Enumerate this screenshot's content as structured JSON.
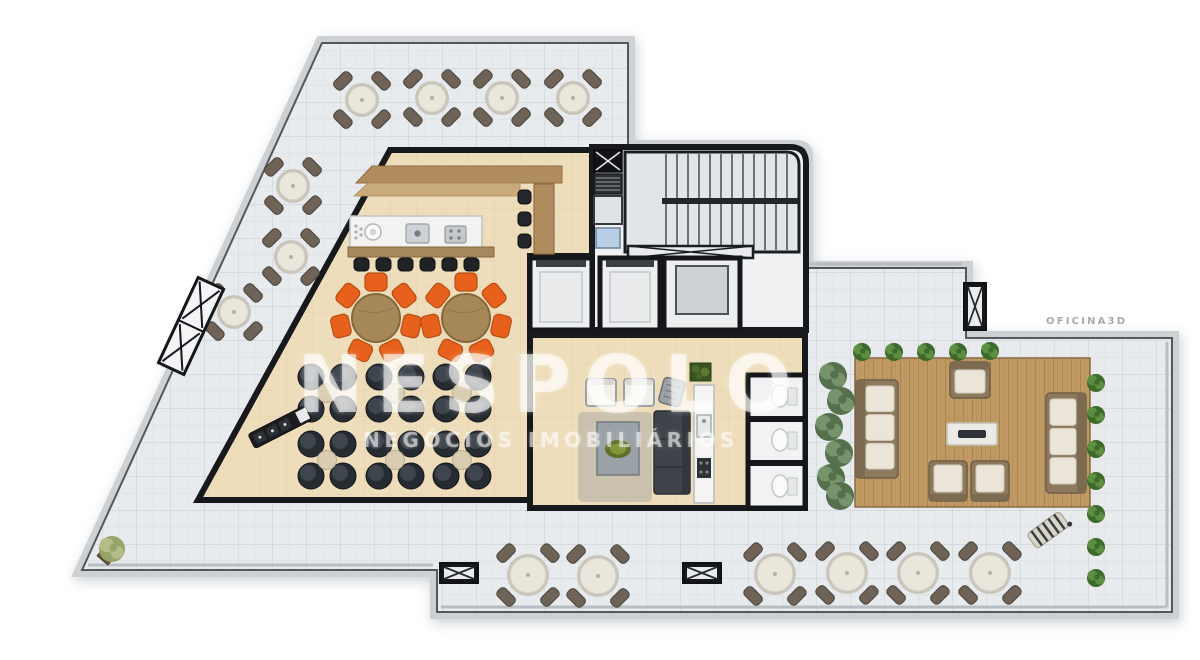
{
  "watermark": {
    "title": "NESPOLO",
    "subtitle": "NEGÓCIOS IMOBILIÁRIOS"
  },
  "credit": {
    "label": "OFICINA3D"
  },
  "palette": {
    "tile_floor": "#e8ebee",
    "tile_line": "#d0d5da",
    "room_floor": "#eeddbb",
    "wall": "#17191c",
    "wood_counter": "#b08c5e",
    "deck_wood": "#bf9a64",
    "accent_orange": "#e8611c",
    "orange_edge": "#b84e12",
    "dark_chair": "#262b31",
    "outdoor_chair": "#6e6356",
    "table_top": "#e9e6dc",
    "cushion": "#eae5d8",
    "sofa_frame": "#8d7a5e",
    "plant_green": "#3e6b2c",
    "plant_light": "#5d8f43",
    "planter_green": "#55704c",
    "planter_light": "#76936b"
  },
  "furniture": {
    "outdoor_tables": [
      {
        "x": 362,
        "y": 100,
        "r": 17
      },
      {
        "x": 432,
        "y": 98,
        "r": 17
      },
      {
        "x": 502,
        "y": 98,
        "r": 17
      },
      {
        "x": 573,
        "y": 98,
        "r": 17
      },
      {
        "x": 293,
        "y": 186,
        "r": 17
      },
      {
        "x": 291,
        "y": 257,
        "r": 17
      },
      {
        "x": 234,
        "y": 312,
        "r": 17
      },
      {
        "x": 528,
        "y": 575,
        "r": 21
      },
      {
        "x": 598,
        "y": 576,
        "r": 21
      },
      {
        "x": 775,
        "y": 574,
        "r": 21
      },
      {
        "x": 847,
        "y": 573,
        "r": 21
      },
      {
        "x": 918,
        "y": 573,
        "r": 21
      },
      {
        "x": 990,
        "y": 573,
        "r": 21
      }
    ],
    "orange_dining": [
      {
        "x": 376,
        "y": 318
      },
      {
        "x": 466,
        "y": 318
      }
    ],
    "lounge_clusters": [
      {
        "x": 327,
        "y": 393
      },
      {
        "x": 395,
        "y": 393
      },
      {
        "x": 462,
        "y": 393
      },
      {
        "x": 327,
        "y": 460
      },
      {
        "x": 395,
        "y": 460
      },
      {
        "x": 462,
        "y": 460
      }
    ],
    "bar_stools": [
      {
        "x": 354,
        "y": 258
      },
      {
        "x": 376,
        "y": 258
      },
      {
        "x": 398,
        "y": 258
      },
      {
        "x": 420,
        "y": 258
      },
      {
        "x": 442,
        "y": 258
      },
      {
        "x": 464,
        "y": 258
      }
    ],
    "counter_stools": [
      {
        "x": 518,
        "y": 190
      },
      {
        "x": 518,
        "y": 212
      },
      {
        "x": 518,
        "y": 234
      }
    ],
    "lounge_armchairs": [
      {
        "x": 586,
        "y": 379
      },
      {
        "x": 624,
        "y": 379
      }
    ],
    "grill": {
      "x": 672,
      "y": 392,
      "rot": 15
    },
    "buffet": {
      "x": 280,
      "y": 427,
      "rot": -27
    },
    "deck_sofas": [
      {
        "x": 856,
        "y": 380,
        "w": 42,
        "h": 98,
        "back": "left"
      },
      {
        "x": 1046,
        "y": 393,
        "w": 40,
        "h": 100,
        "back": "right"
      }
    ],
    "deck_armchairs": [
      {
        "x": 950,
        "y": 362,
        "w": 40,
        "h": 36,
        "back": "top"
      },
      {
        "x": 929,
        "y": 461,
        "w": 38,
        "h": 40,
        "back": "bottom"
      },
      {
        "x": 971,
        "y": 461,
        "w": 38,
        "h": 40,
        "back": "bottom"
      }
    ],
    "fire_table": {
      "x": 947,
      "y": 423,
      "w": 50,
      "h": 22
    },
    "deck_edge_plants": [
      {
        "x": 862,
        "y": 352
      },
      {
        "x": 894,
        "y": 352
      },
      {
        "x": 926,
        "y": 352
      },
      {
        "x": 958,
        "y": 352
      },
      {
        "x": 990,
        "y": 351
      },
      {
        "x": 1096,
        "y": 383
      },
      {
        "x": 1096,
        "y": 415
      },
      {
        "x": 1096,
        "y": 449
      },
      {
        "x": 1096,
        "y": 481
      },
      {
        "x": 1096,
        "y": 514
      },
      {
        "x": 1096,
        "y": 547
      },
      {
        "x": 1096,
        "y": 578
      }
    ],
    "planter_strip_plants": [
      {
        "x": 833,
        "y": 376
      },
      {
        "x": 841,
        "y": 401
      },
      {
        "x": 829,
        "y": 427
      },
      {
        "x": 839,
        "y": 453
      },
      {
        "x": 831,
        "y": 478
      },
      {
        "x": 840,
        "y": 496
      }
    ],
    "corner_plant": {
      "x": 112,
      "y": 549
    },
    "loungers": [
      {
        "x": 1048,
        "y": 530,
        "rot": -36
      }
    ],
    "grates": [
      {
        "x": 440,
        "y": 563,
        "w": 38,
        "h": 20
      },
      {
        "x": 683,
        "y": 563,
        "w": 38,
        "h": 20
      }
    ],
    "pillar": {
      "x": 964,
      "y": 283,
      "w": 22,
      "h": 47
    },
    "edge_trellis": {
      "x": 191,
      "y": 326,
      "rot": 25,
      "w": 28,
      "h": 94
    }
  }
}
